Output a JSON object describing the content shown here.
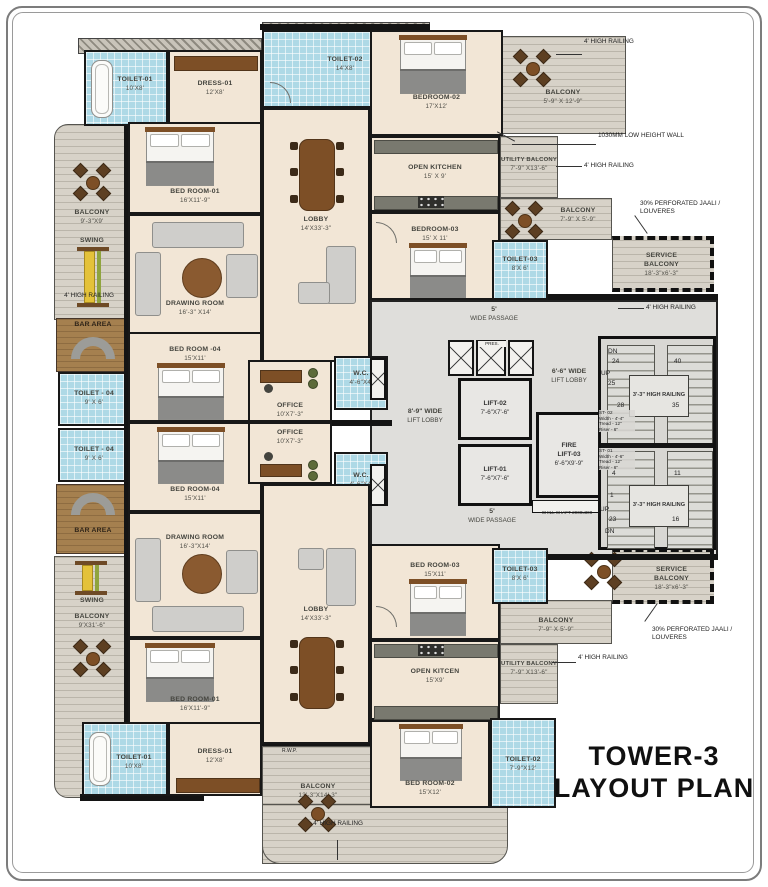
{
  "title": {
    "line1": "TOWER-3",
    "line2": "LAYOUT PLAN"
  },
  "rooms": {
    "toilet01_top": {
      "name": "TOILET-01",
      "size": "10'X8'"
    },
    "dress01_top": {
      "name": "DRESS-01",
      "size": "12'X8'"
    },
    "toilet02_top": {
      "name": "TOILET-02",
      "size": "14'X8'"
    },
    "bedroom02_top": {
      "name": "BEDROOM-02",
      "size": "17'X12'"
    },
    "balcony_tr": {
      "name": "BALCONY",
      "size": "5'-9\" X 12'-9\""
    },
    "open_kitchen_top": {
      "name": "OPEN KITCHEN",
      "size": "15' X 9'"
    },
    "bedroom03_top": {
      "name": "BEDROOM-03",
      "size": "15' X 11'"
    },
    "toilet03_top": {
      "name": "TOILET-03",
      "size": "8'X 6'"
    },
    "utility_balcony_top": {
      "name": "UTILITY BALCONY",
      "size": "7'-9\" X13'-6\""
    },
    "balcony_top_small": {
      "name": "BALCONY",
      "size": "7'-9\" X 5'-9\""
    },
    "service_balcony_top": {
      "name": "SERVICE BALCONY",
      "size": "18'-3\"x6'-3\""
    },
    "passage_top": {
      "name": "5'",
      "size": "WIDE PASSAGE"
    },
    "balcony_left_top": {
      "name": "BALCONY",
      "size": "9'-3\"X9'"
    },
    "swing_top": {
      "label": "SWING"
    },
    "bar_top": {
      "label": "BAR AREA"
    },
    "bedroom01_top": {
      "name": "BED ROOM-01",
      "size": "16'X11'-9\""
    },
    "drawing_room_top": {
      "name": "DRAWING ROOM",
      "size": "16'-3\" X14'"
    },
    "lobby_top": {
      "name": "LOBBY",
      "size": "14'X33'-3\""
    },
    "bedroom04_top": {
      "name": "BED ROOM -04",
      "size": "15'X11'"
    },
    "toilet04_a": {
      "name": "TOILET - 04",
      "size": "9' X 6'"
    },
    "toilet04_b": {
      "name": "TOILET - 04",
      "size": "9' X 6'"
    },
    "office_a": {
      "name": "OFFICE",
      "size": "10'X7'-3\""
    },
    "office_b": {
      "name": "OFFICE",
      "size": "10'X7'-3\""
    },
    "wc_a": {
      "name": "W.C.",
      "size": "4'-6\"X4'"
    },
    "wc_b": {
      "name": "W.C.",
      "size": "4'-6\"X4'"
    },
    "bedroom04_bot": {
      "name": "BED ROOM-04",
      "size": "15'X11'"
    },
    "drawing_room_bot": {
      "name": "DRAWING ROOM",
      "size": "16'-3\"X14'"
    },
    "bar_bot": {
      "label": "BAR AREA"
    },
    "swing_bot": {
      "label": "SWING"
    },
    "balcony_left_bot": {
      "name": "BALCONY",
      "size": "9'X31'-6\""
    },
    "bedroom01_bot": {
      "name": "BED ROOM-01",
      "size": "16'X11'-9\""
    },
    "toilet01_bot": {
      "name": "TOILET-01",
      "size": "10'X8'"
    },
    "dress01_bot": {
      "name": "DRESS-01",
      "size": "12'X8'"
    },
    "lobby_bot": {
      "name": "LOBBY",
      "size": "14'X33'-3\""
    },
    "bedroom03_bot": {
      "name": "BED ROOM-03",
      "size": "15'X11'"
    },
    "toilet03_bot": {
      "name": "TOILET-03",
      "size": "8'X 6'"
    },
    "balcony_bot_small": {
      "name": "BALCONY",
      "size": "7'-9\" X 5'-9\""
    },
    "open_kitchen_bot": {
      "name": "OPEN KITCEN",
      "size": "15'X9'"
    },
    "utility_balcony_bot": {
      "name": "UTILITY BALCONY",
      "size": "7'-9\" X13'-6\""
    },
    "service_balcony_bot": {
      "name": "SERVICE BALCONY",
      "size": "18'-3\"x6'-3\""
    },
    "passage_bot": {
      "name": "5'",
      "size": "WIDE PASSAGE"
    },
    "bedroom02_bot": {
      "name": "BED ROOM-02",
      "size": "15'X12'"
    },
    "toilet02_bot": {
      "name": "TOILET-02",
      "size": "7'-9\"X12'"
    },
    "balcony_bottom": {
      "name": "BALCONY",
      "size": "13'-3\"X14'-3\""
    },
    "rwp": {
      "label": "R.W.P."
    }
  },
  "core": {
    "lift_lobby_main": {
      "name": "8'-9\" WIDE",
      "size": "LIFT LOBBY"
    },
    "lift_lobby_fire": {
      "name": "6'-6\" WIDE",
      "size": "LIFT LOBBY"
    },
    "lift02": {
      "name": "LIFT-02",
      "size": "7'-6\"X7'-6\""
    },
    "lift01": {
      "name": "LIFT-01",
      "size": "7'-6\"X7'-6\""
    },
    "fire_lift": {
      "name": "FIRE",
      "name2": "LIFT-03",
      "size": "6'-6\"X9'-9\""
    },
    "chill_shaft": {
      "label": "CHILL SHAFT 2000x300"
    },
    "pres_shaft": {
      "label": "PRES."
    }
  },
  "stairs": {
    "st02": {
      "id": "ST- 02",
      "width": "Width - 4'-4\"",
      "tread": "Tread - 12\"",
      "riser": "Riser - 6\"",
      "railing": "3'-3\" HIGH RAILING",
      "dn": "DN",
      "n24": "24",
      "up": "UP",
      "n25": "25",
      "n28": "28",
      "n40": "40",
      "n35": "35"
    },
    "st01": {
      "id": "ST- 01",
      "width": "Width - 4'-6\"",
      "tread": "Tread - 12\"",
      "riser": "Riser - 6\"",
      "railing": "3'-3\" HIGH RAILING",
      "n4": "4",
      "n11": "11",
      "n1": "1",
      "up": "UP",
      "n23": "23",
      "dn": "DN",
      "n16": "16"
    }
  },
  "annotations": {
    "rail_tr": "4' HIGH RAILING",
    "low_wall": "1030MM LOW HEIGHT WALL",
    "rail_tr2": "4' HIGH RAILING",
    "jaali_top": "30% PERFORATED JAALI / LOUVERES",
    "rail_mid": "4' HIGH RAILING",
    "jaali_bot": "30% PERFORATED JAALI / LOUVERES",
    "rail_br": "4' HIGH RAILING",
    "rail_left": "4' HIGH RAILING",
    "rail_bottom": "4' HIGH RAILING"
  },
  "colors": {
    "wall": "#161616",
    "floor": "#f2e6d6",
    "tile": "#aed9e6",
    "balcony": "#d7d2c8",
    "core": "#dfdedb",
    "wood": "#7d4f26",
    "swing": "#e4c23a"
  }
}
